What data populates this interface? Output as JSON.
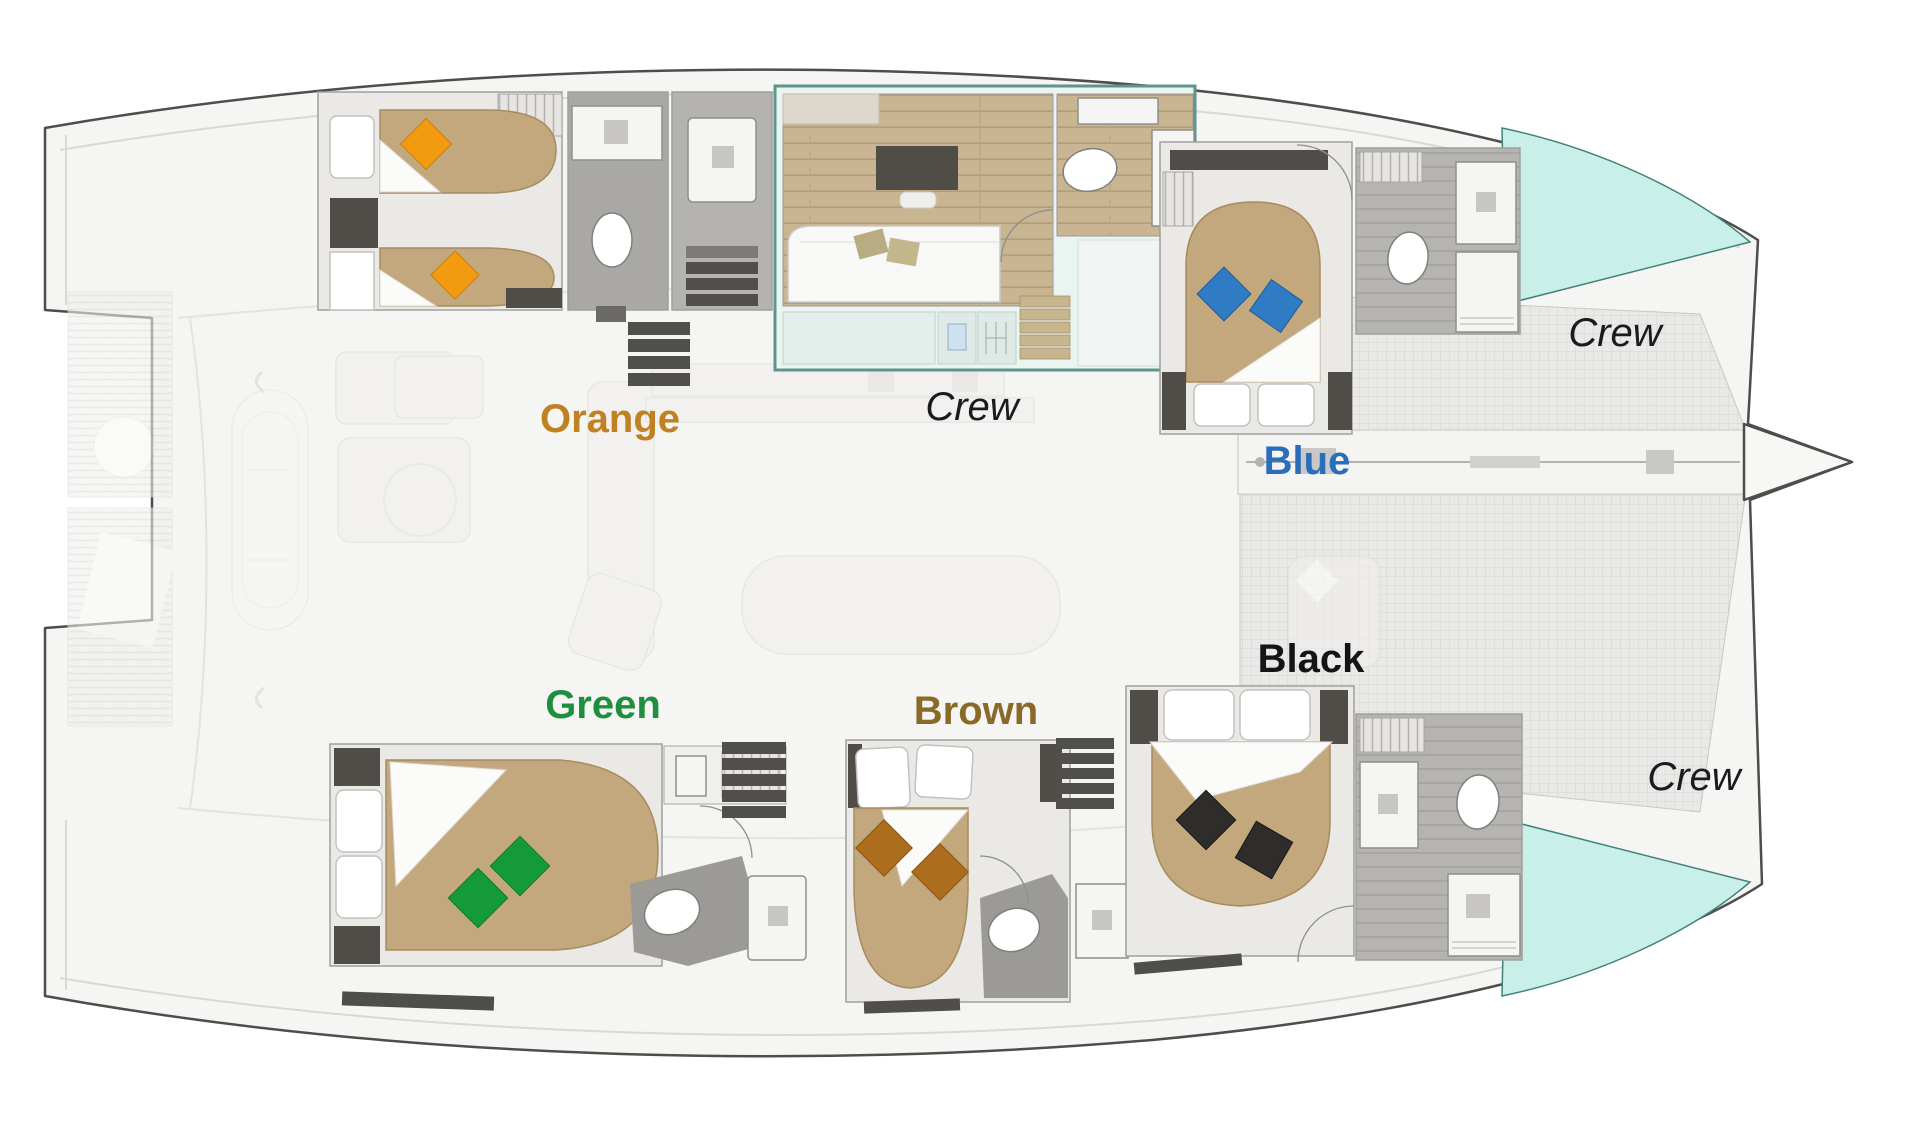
{
  "plan": {
    "type": "Catamaran yacht cabin layout deck plan",
    "background": "#ffffff"
  },
  "cabins": {
    "orange": {
      "label": "Orange",
      "label_color": "#bf8121",
      "pillow_color": "#f29b11",
      "beds": "2 single beds"
    },
    "blue": {
      "label": "Blue",
      "label_color": "#2a6db8",
      "pillow_color": "#2f7cc4",
      "beds": "1 double bed"
    },
    "green": {
      "label": "Green",
      "label_color": "#1e8f3e",
      "pillow_color": "#149a39",
      "beds": "1 double bed"
    },
    "brown": {
      "label": "Brown",
      "label_color": "#8a6a28",
      "pillow_color": "#ad6d1e",
      "beds": "1 double bed"
    },
    "black": {
      "label": "Black",
      "label_color": "#141414",
      "pillow_color": "#2e2d2b",
      "beds": "1 double bed"
    },
    "crew_cabin": {
      "label": "Crew",
      "label_color": "#1b1b1b"
    },
    "crew_bow_port": {
      "label": "Crew",
      "label_color": "#1b1b1b"
    },
    "crew_bow_starboard": {
      "label": "Crew",
      "label_color": "#1b1b1b"
    }
  },
  "colors": {
    "crew_area_fill": "#c8f0e8",
    "crew_area_stroke": "#44807a",
    "duvet_tan": "#c3a77d",
    "wood_floor": "#c9b592",
    "hull_fill": "#f5f5f3",
    "hull_stroke": "#4d4d4b",
    "bathroom_floor_dark": "#a9a8a5"
  }
}
